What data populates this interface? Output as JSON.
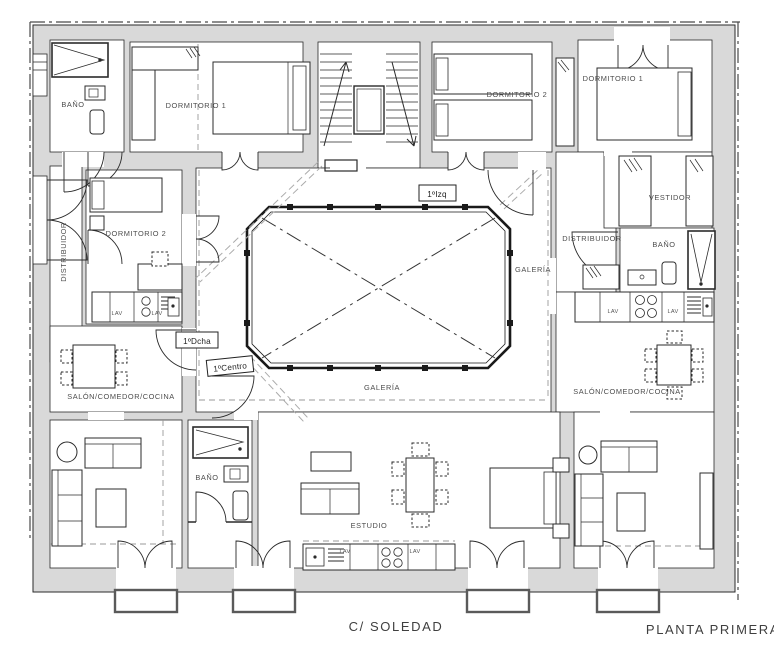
{
  "plan": {
    "street": "C/ SOLEDAD",
    "title": "PLANTA PRIMERA"
  },
  "units": {
    "izq": "1ºIzq",
    "dcha": "1ºDcha",
    "centro": "1ºCentro"
  },
  "rooms": {
    "bano_nw": "BAÑO",
    "dorm1_nw": "DORMITORIO 1",
    "dorm2_n": "DORMITORIO 2",
    "dorm1_ne": "DORMITORIO 1",
    "vestidor": "VESTIDOR",
    "distribuidor_w": "DISTRIBUIDOR",
    "dorm2_w": "DORMITORIO 2",
    "salon_w": "SALÓN/COMEDOR/COCINA",
    "galeria_s": "GALERÍA",
    "galeria_e": "GALERÍA",
    "distribuidor_e": "DISTRIBUIDOR",
    "bano_e": "BAÑO",
    "salon_e": "SALÓN/COMEDOR/COCINA",
    "bano_s": "BAÑO",
    "estudio": "ESTUDIO"
  },
  "appliances": {
    "lav_w1": "LAV",
    "lav_w2": "LAV",
    "lav_e1": "LAV",
    "lav_e2": "LAV",
    "lav_s1": "LAV",
    "lav_s2": "LAV"
  },
  "colors": {
    "wall": "#d9d9d9",
    "line": "#1a1a1a",
    "label": "#4d4d4d"
  }
}
